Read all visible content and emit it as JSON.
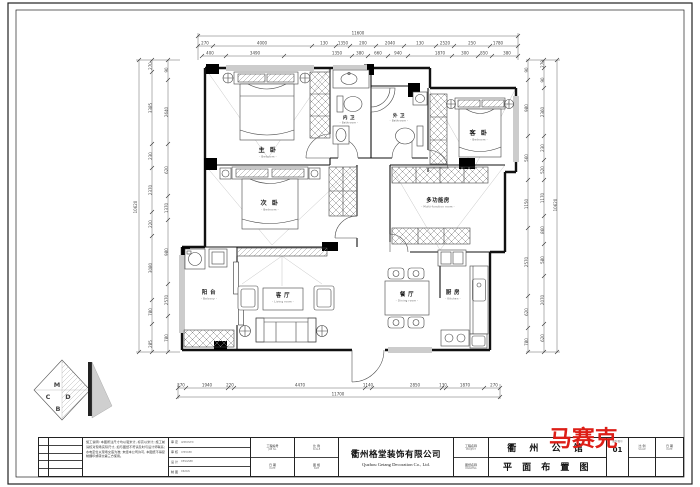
{
  "page": {
    "bg": "#ffffff",
    "line_color": "#1a1a1a",
    "accent_red": "#dd1e17"
  },
  "rooms": {
    "master": {
      "name": "主 卧",
      "sub": "- Bedroom -"
    },
    "nei_wei": {
      "name": "内 卫",
      "sub": "- Bathroom -"
    },
    "wai_wei": {
      "name": "外 卫",
      "sub": "- Bathroom -"
    },
    "guest": {
      "name": "客 卧",
      "sub": "- Bedroom -"
    },
    "second": {
      "name": "次 卧",
      "sub": "- Bedroom -"
    },
    "multi": {
      "name": "多功能房",
      "sub": "- Multi-function room -"
    },
    "balcony": {
      "name": "阳 台",
      "sub": "- Balcony -"
    },
    "living": {
      "name": "客 厅",
      "sub": "- Living room -"
    },
    "dining": {
      "name": "餐 厅",
      "sub": "- Dining room -"
    },
    "kitchen": {
      "name": "厨 房",
      "sub": "- Kitchen -"
    }
  },
  "dims": {
    "top_total": "11600",
    "top_mid": [
      "270",
      "4000",
      "130",
      "1350",
      "200",
      "2040",
      "130",
      "2520",
      "250",
      "1780"
    ],
    "top_inner": [
      "400",
      "3490",
      "1350",
      "380",
      "660",
      "940",
      "1870",
      "300",
      "850",
      "380"
    ],
    "bottom": [
      "270",
      "1940",
      "220",
      "4470",
      "1140",
      "2850",
      "130",
      "1870",
      "270"
    ],
    "bottom_total": "11700",
    "left_outer": [
      "270",
      "3385",
      "230",
      "2370",
      "220",
      "3080",
      "780",
      "285"
    ],
    "left_inner": [
      "90",
      "2640",
      "620",
      "1370",
      "980",
      "2570",
      "780"
    ],
    "left_total": "10620",
    "right_outer": [
      "270",
      "90",
      "2360",
      "230",
      "520",
      "1170",
      "860",
      "580",
      "2070",
      "620"
    ],
    "right_inner": [
      "90",
      "980",
      "560",
      "1150",
      "2570",
      "620",
      "780"
    ],
    "right_total": "10620"
  },
  "titleblock": {
    "company_cn": "衢州格堂装饰有限公司",
    "company_en": "Quzhou Getang Decoration Co., Ltd.",
    "project_label_cn": "工程名称",
    "project_label_en": "PROJECT",
    "drawing_label_cn": "图纸名称",
    "drawing_label_en": "DRAWING",
    "project_name": "衢 州 公 馆",
    "drawing_name": "平 面 布 置 图",
    "logo_text": "马赛克",
    "sheet_no_label": "图别/图号",
    "sheet_no": "01",
    "scale_label_cn": "比 例",
    "scale_label_en": "SCALE",
    "date_label_cn": "日 期",
    "date_label_en": "DATE",
    "approvals": [
      {
        "cn": "审 定",
        "en": "APPROVED"
      },
      {
        "cn": "审 核",
        "en": "CHECKED"
      },
      {
        "cn": "设 计",
        "en": "DESIGNED"
      },
      {
        "cn": "制 图",
        "en": "DRAWN"
      }
    ],
    "info": [
      {
        "cn": "工程编号",
        "en": "JOB No."
      },
      {
        "cn": "日 期",
        "en": "DATE"
      },
      {
        "cn": "比 例",
        "en": "SCALE"
      },
      {
        "cn": "图 幅",
        "en": "SIZE"
      }
    ],
    "notes": "施工说明: 本图所注尺寸均以毫米计, 标高以米计; 施工前请核对现场实际尺寸, 如与图纸不符请及时与设计师联系; 水电定位以现场交底为准; 未经本公司许可, 本图纸不得复制翻印或转交第三方使用。"
  },
  "stamp": {
    "letters": [
      "M",
      "C",
      "D",
      "B"
    ]
  }
}
